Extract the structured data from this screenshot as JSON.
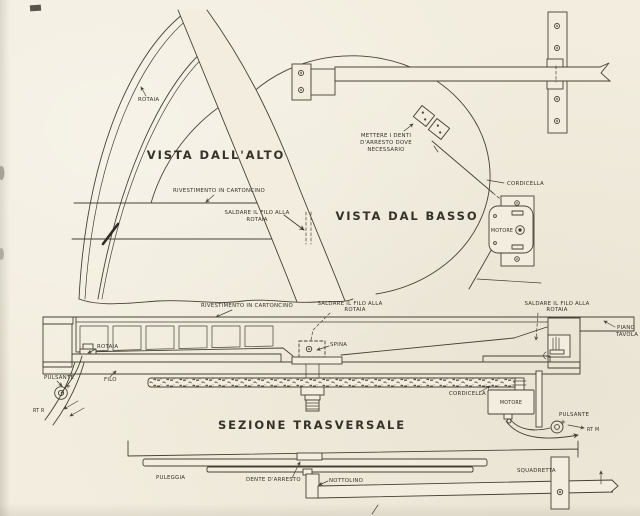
{
  "colors": {
    "paper": "#f2edde",
    "ink": "#454134",
    "ink_strong": "#35322a"
  },
  "top_view": {
    "title": "VISTA DALL'ALTO",
    "rotaia": "ROTAIA",
    "rivestimento": "RIVESTIMENTO IN CARTONCINO",
    "saldare_l1": "SALDARE IL FILO ALLA",
    "saldare_l2": "ROTAIA"
  },
  "bottom_view": {
    "title": "VISTA DAL BASSO",
    "mettere_l1": "METTERE I DENTI",
    "mettere_l2": "D'ARRESTO DOVE",
    "mettere_l3": "NECESSARIO",
    "cordicella": "CORDICELLA",
    "motore": "MOTORE"
  },
  "section": {
    "title": "SEZIONE TRASVERSALE",
    "rivestimento": "RIVESTIMENTO IN CARTONCINO",
    "saldare_center_l1": "SALDARE IL FILO ALLA",
    "saldare_center_l2": "ROTAIA",
    "saldare_right_l1": "SALDARE IL FILO ALLA",
    "saldare_right_l2": "ROTAIA",
    "piano_l1": "PIANO",
    "piano_l2": "TAVOLA",
    "spina": "SPINA",
    "rotaia": "ROTAIA",
    "pulsante_left": "PULSANTE",
    "filo": "FILO",
    "rt_r": "RT R",
    "cordicella": "CORDICELLA",
    "motore": "MOTORE",
    "pulsante_right": "PULSANTE",
    "rt_m": "RT M"
  },
  "underside_view": {
    "puleggia": "PULEGGIA",
    "dente_arresto": "DENTE D'ARRESTO",
    "nottolino": "NOTTOLINO",
    "squadretta": "SQUADRETTA"
  }
}
